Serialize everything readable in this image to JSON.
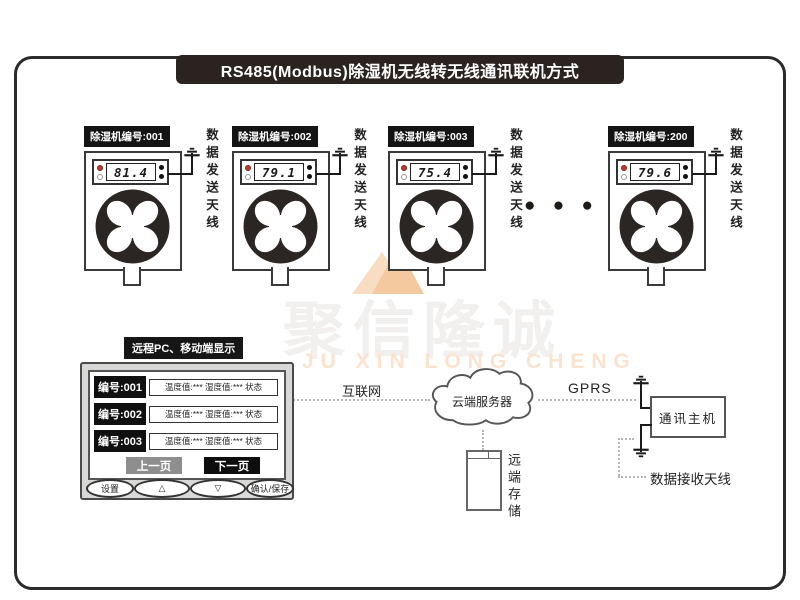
{
  "title": "RS485(Modbus)除湿机无线转无线通讯联机方式",
  "units": [
    {
      "label": "除湿机编号:001",
      "value": "81.4",
      "antenna_label": "数据发送天线"
    },
    {
      "label": "除湿机编号:002",
      "value": "79.1",
      "antenna_label": "数据发送天线"
    },
    {
      "label": "除湿机编号:003",
      "value": "75.4",
      "antenna_label": "数据发送天线"
    },
    {
      "label": "除湿机编号:200",
      "value": "79.6",
      "antenna_label": "数据发送天线"
    }
  ],
  "ellipsis": "● ● ●",
  "monitor": {
    "header": "远程PC、移动端显示",
    "rows": [
      {
        "id": "编号:001",
        "info": "温度值:*** 湿度值:*** 状态"
      },
      {
        "id": "编号:002",
        "info": "温度值:*** 湿度值:*** 状态"
      },
      {
        "id": "编号:003",
        "info": "温度值:*** 湿度值:*** 状态"
      }
    ],
    "prev_button": "上一页",
    "next_button": "下一页",
    "buttons": [
      "设置",
      "△",
      "▽",
      "确认/保存"
    ]
  },
  "network": {
    "internet_label": "互联网",
    "cloud_label": "云端服务器",
    "gprs_label": "GPRS",
    "host_label": "通讯主机",
    "receive_antenna_label": "数据接收天线",
    "storage_label": "远端存储"
  },
  "watermark": {
    "cn": "聚信隆诚",
    "en": "JU XIN LONG CHENG"
  },
  "colors": {
    "banner_bg": "#2b2320",
    "label_bg": "#141414",
    "led_red": "#c23b2e",
    "fan_dark": "#2b2523",
    "watermark_gray": "#f2f0ee",
    "watermark_orange": "#f4c9a0"
  }
}
